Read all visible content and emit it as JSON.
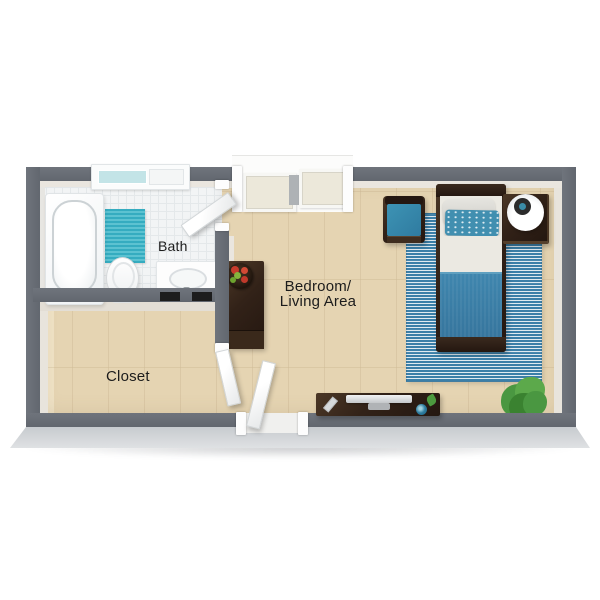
{
  "meta": {
    "type": "3d-floor-plan",
    "view": "top-down studio apartment"
  },
  "rooms": {
    "bath": {
      "label": "Bath"
    },
    "closet": {
      "label": "Closet"
    },
    "bedroom": {
      "label_line1": "Bedroom/",
      "label_line2": "Living Area"
    }
  },
  "furniture": {
    "bath": [
      "bathtub",
      "bath-rug",
      "toilet",
      "sink-vanity",
      "window",
      "bath-door"
    ],
    "closet": [
      "closet-door"
    ],
    "bedroom": [
      "armchair",
      "twin-bed",
      "nightstand",
      "table-lamp",
      "striped-area-rug",
      "console-cabinet",
      "fruit-bowl",
      "media-desk",
      "tv",
      "remote",
      "mug",
      "potted-plant",
      "entry-door",
      "sliding-door-wardrobe"
    ]
  },
  "palette": {
    "wall": "#6f747c",
    "wall_dark": "#62676f",
    "wall_face": "#eae6df",
    "slab": "#ccd0d4",
    "tile": "#f2f4f5",
    "tile_line": "#e4e8ea",
    "wood": "#e9dabc",
    "bath_rug": "#35acc0",
    "bath_rug_light": "#5cc2d1",
    "rug_blue": "#3b7fa8",
    "rug_stripe": "#dfeaf0",
    "blanket": "#3c84ad",
    "sheet": "#ebe9e2",
    "pillow": "#dcdbd5",
    "pillow_teal": "#418fb0",
    "cushion": "#3589ab",
    "dark_wood": "#322218",
    "dark_wood_light": "#4b3726",
    "plant": "#4a9741",
    "plant_dark": "#3a8230",
    "plant_light": "#5ca94b",
    "glass": "#c3e4e7",
    "white_fix": "#fdfdfd",
    "label": "#1c1c1c"
  }
}
